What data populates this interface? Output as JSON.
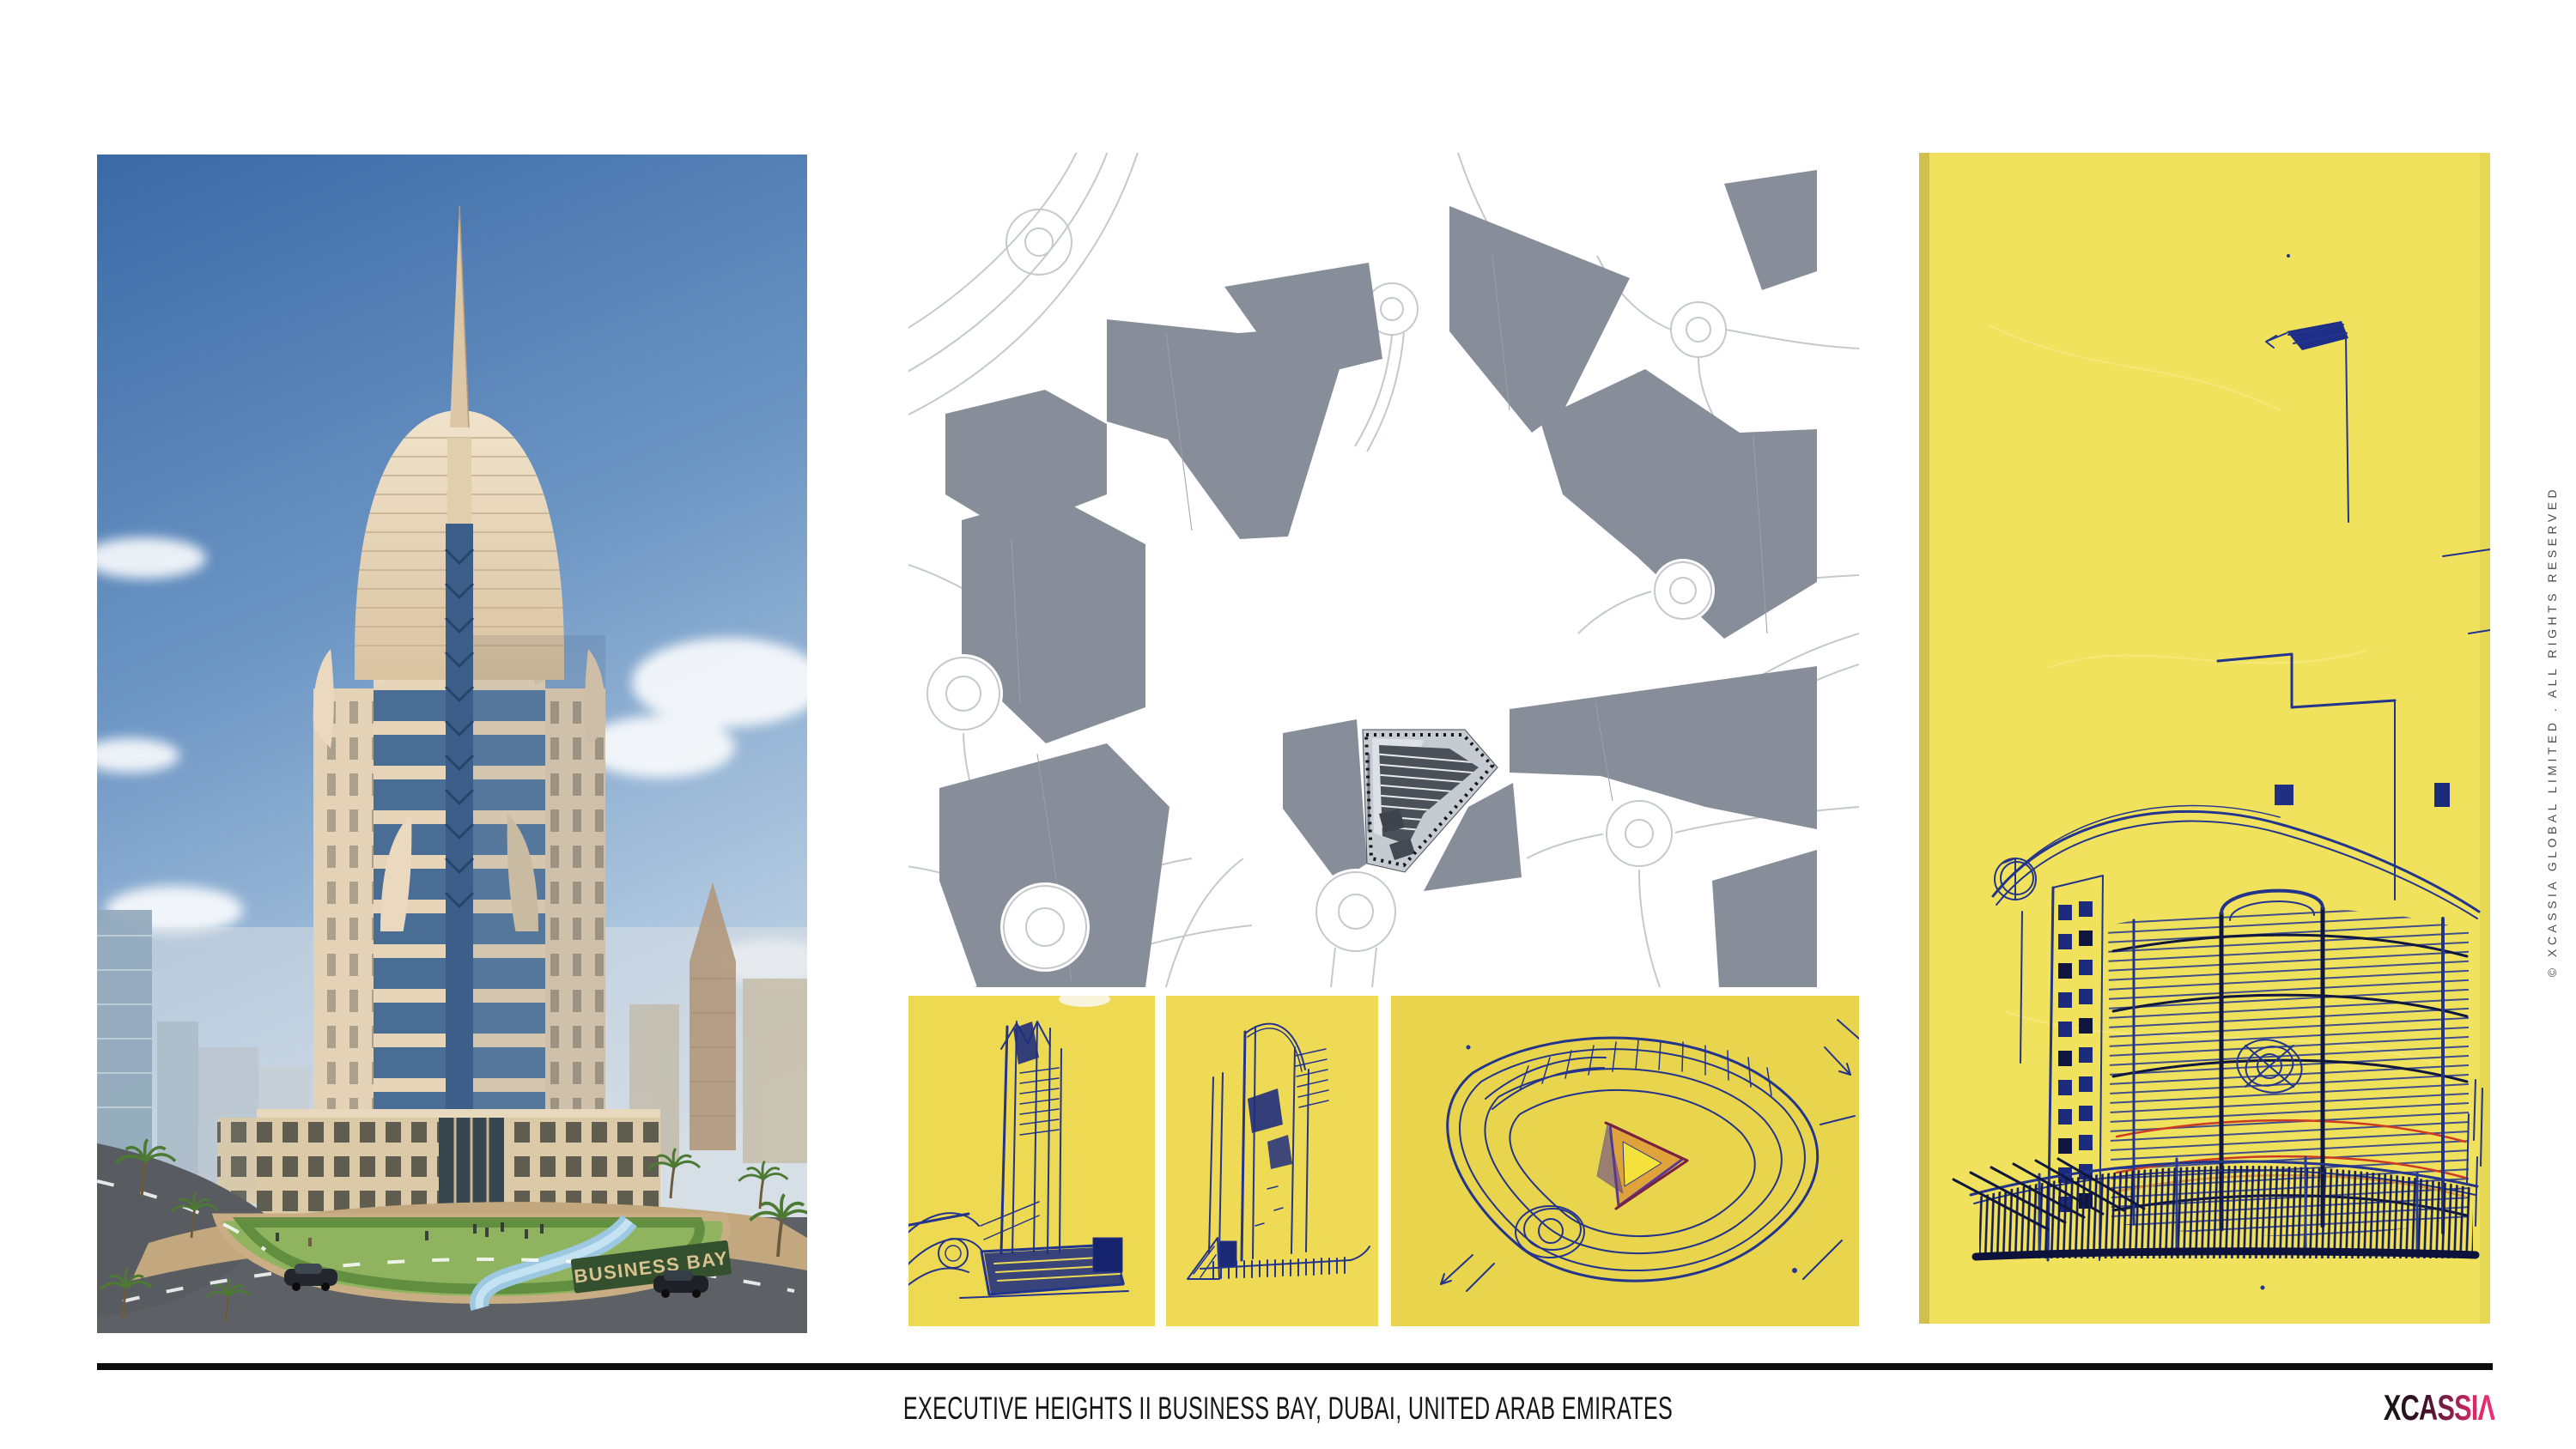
{
  "slide": {
    "caption": "EXECUTIVE HEIGHTS II BUSINESS BAY, DUBAI, UNITED ARAB EMIRATES",
    "copyright": "© XCASSIA GLOBAL LIMITED . ALL RIGHTS RESERVED",
    "logo": {
      "brand": "XCASSIA",
      "display": "XCASSIΛ",
      "gradient_start": "#141414",
      "gradient_mid": "#8c2050",
      "gradient_end": "#ee2f77"
    }
  },
  "photo": {
    "sign_text": "BUSINESS BAY"
  },
  "site_plan": {
    "block_color": "#878e99",
    "road_outline_color": "#c5c8cc",
    "site_pad_color": "#c6cbd1",
    "site_building_color": "#4b5158"
  },
  "sketches": {
    "paper_color": "#eed952",
    "paper_color_large": "#f0e25c",
    "ink_color": "#23348c",
    "accent_red": "#cf3b22",
    "accent_orange": "#e09a35",
    "accent_purple": "#5b3a8e"
  }
}
